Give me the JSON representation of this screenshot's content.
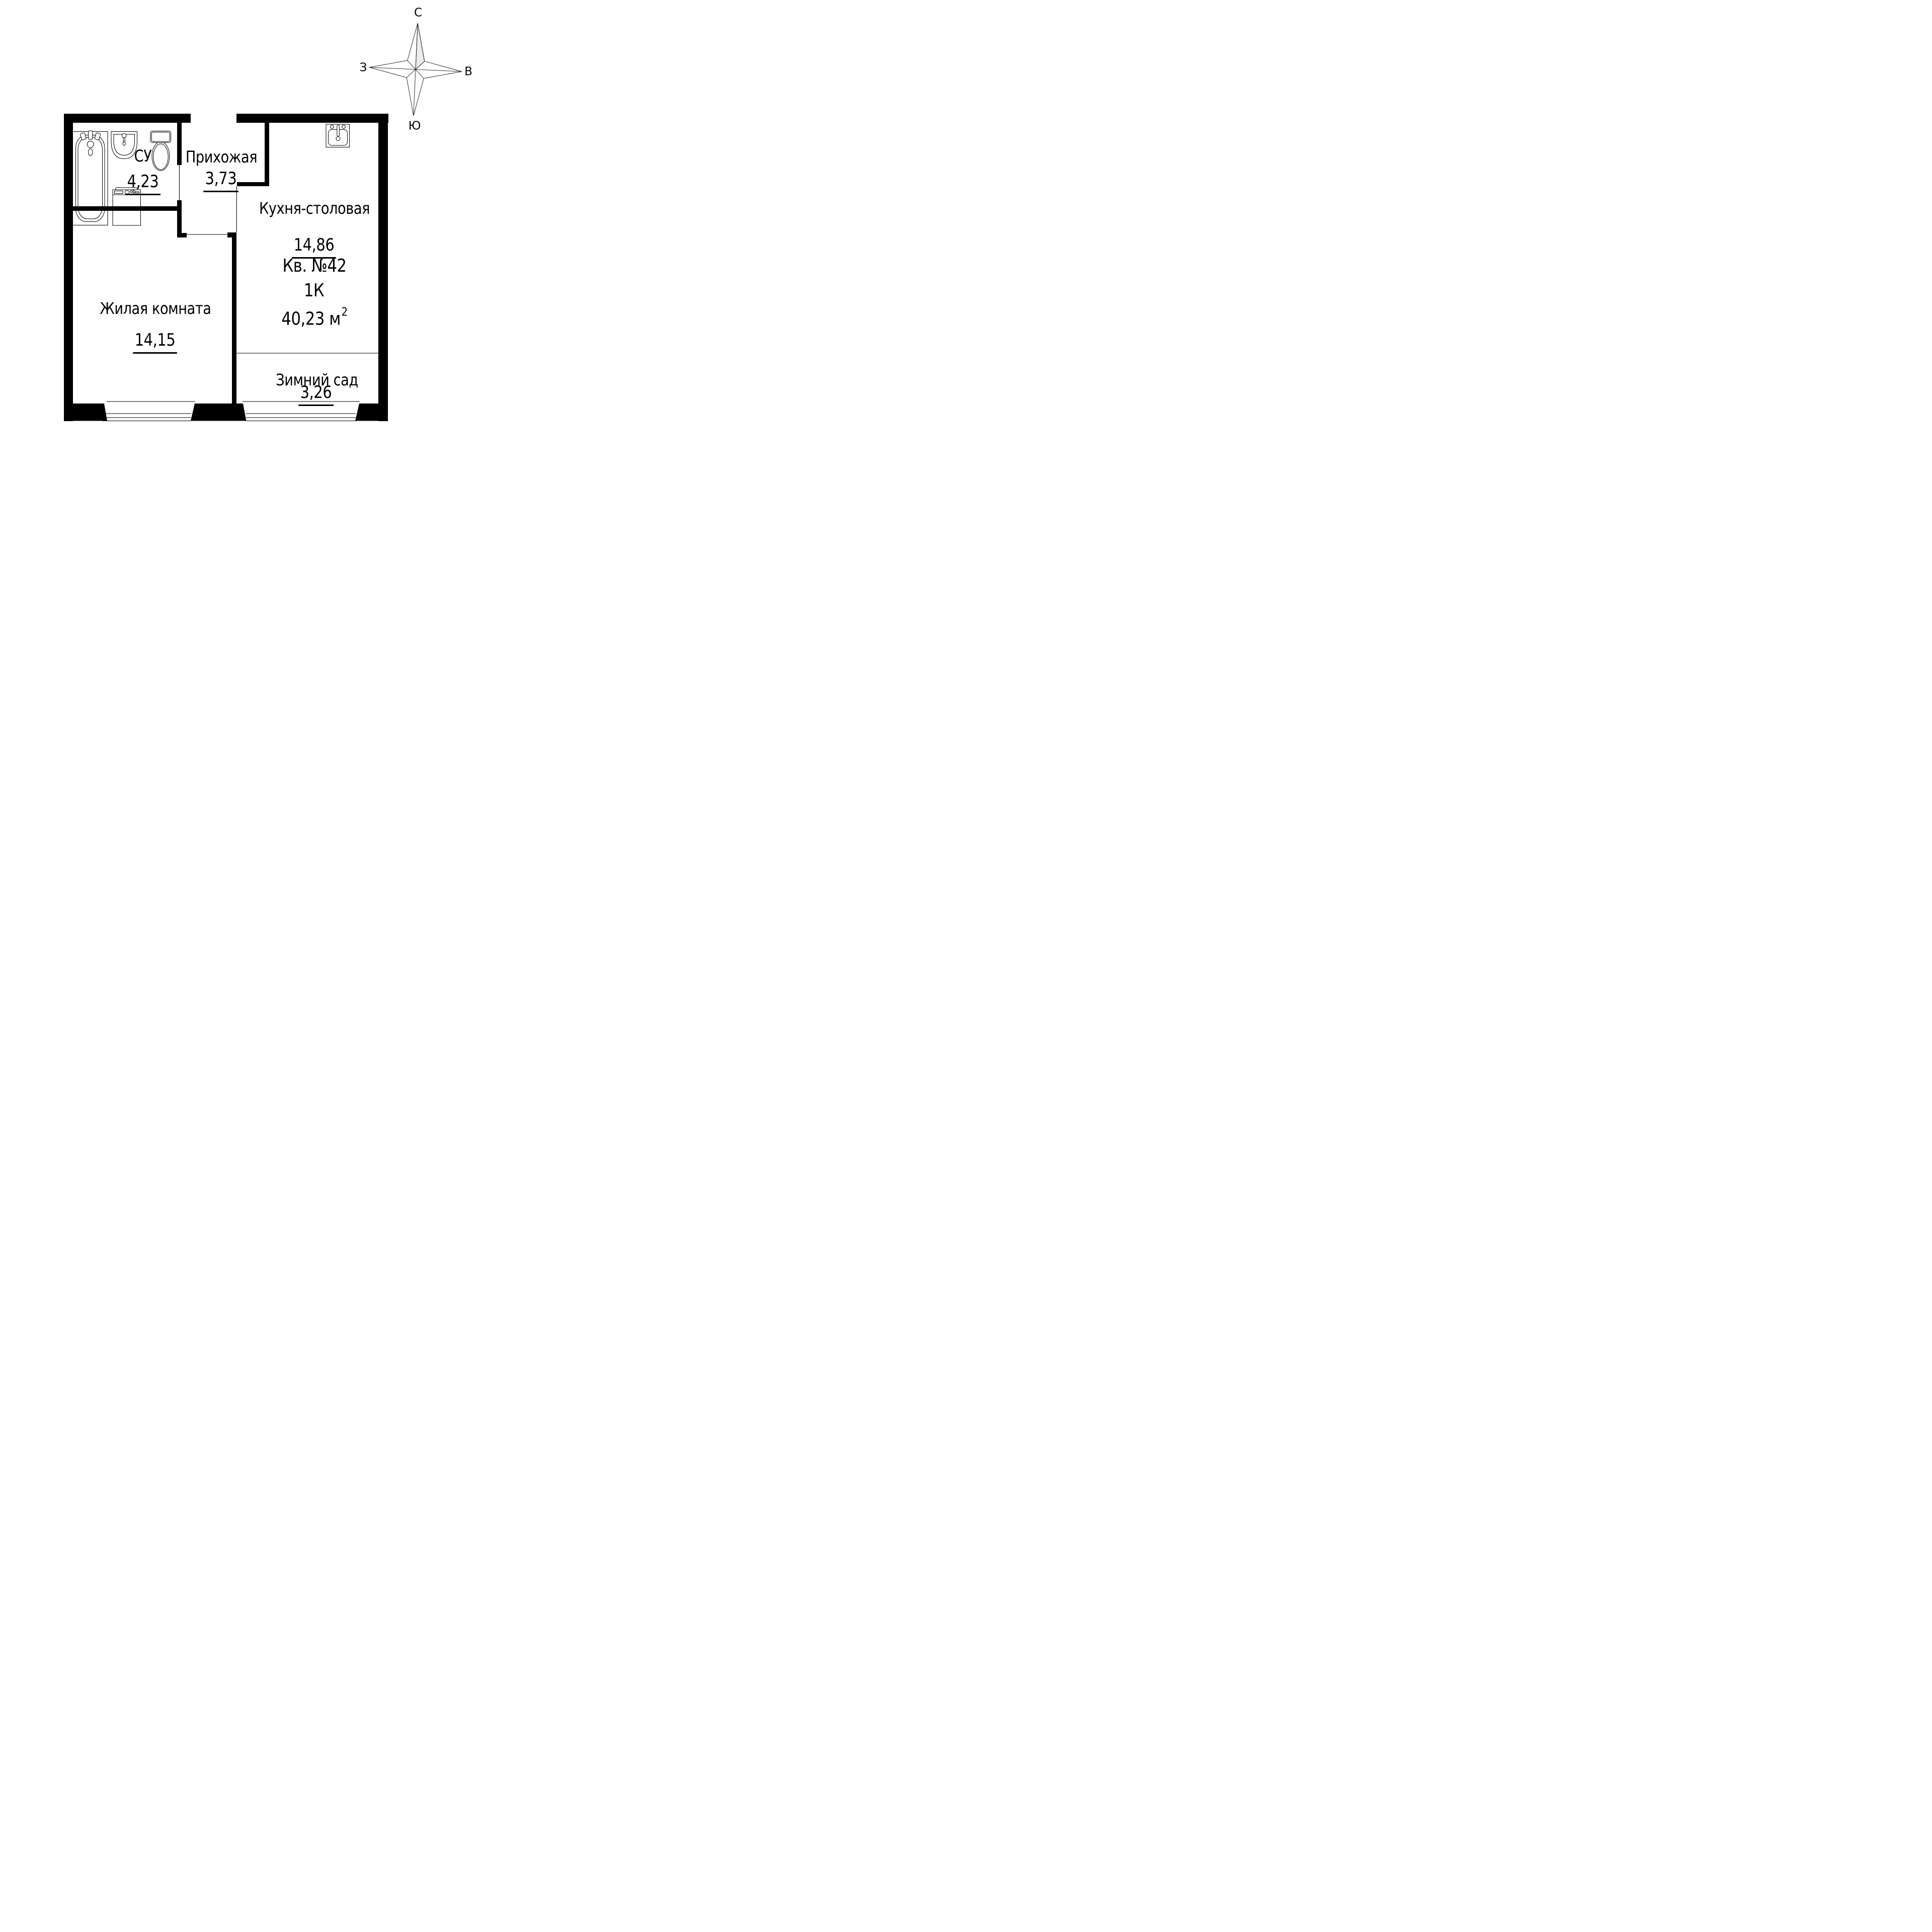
{
  "compass": {
    "north": "С",
    "south": "Ю",
    "west": "З",
    "east": "В"
  },
  "apartment": {
    "number": "Кв. №42",
    "type": "1К",
    "area": "40,23",
    "area_unit": "м",
    "area_sup": "2"
  },
  "rooms": [
    {
      "id": "bathroom",
      "name": "СУ",
      "area": "4,23"
    },
    {
      "id": "hallway",
      "name": "Прихожая",
      "area": "3,73"
    },
    {
      "id": "kitchen",
      "name": "Кухня-столовая",
      "area": "14,86"
    },
    {
      "id": "living",
      "name": "Жилая комната",
      "area": "14,15"
    },
    {
      "id": "winter-garden",
      "name": "Зимний сад",
      "area": "3,26"
    }
  ],
  "colors": {
    "walls": "#000000",
    "compass_shade": "#ececec",
    "background": "#ffffff"
  },
  "icons": [
    "compass-rose-icon",
    "bathtub-icon",
    "washbasin-icon",
    "toilet-icon",
    "washing-machine-icon",
    "kitchen-sink-icon"
  ]
}
